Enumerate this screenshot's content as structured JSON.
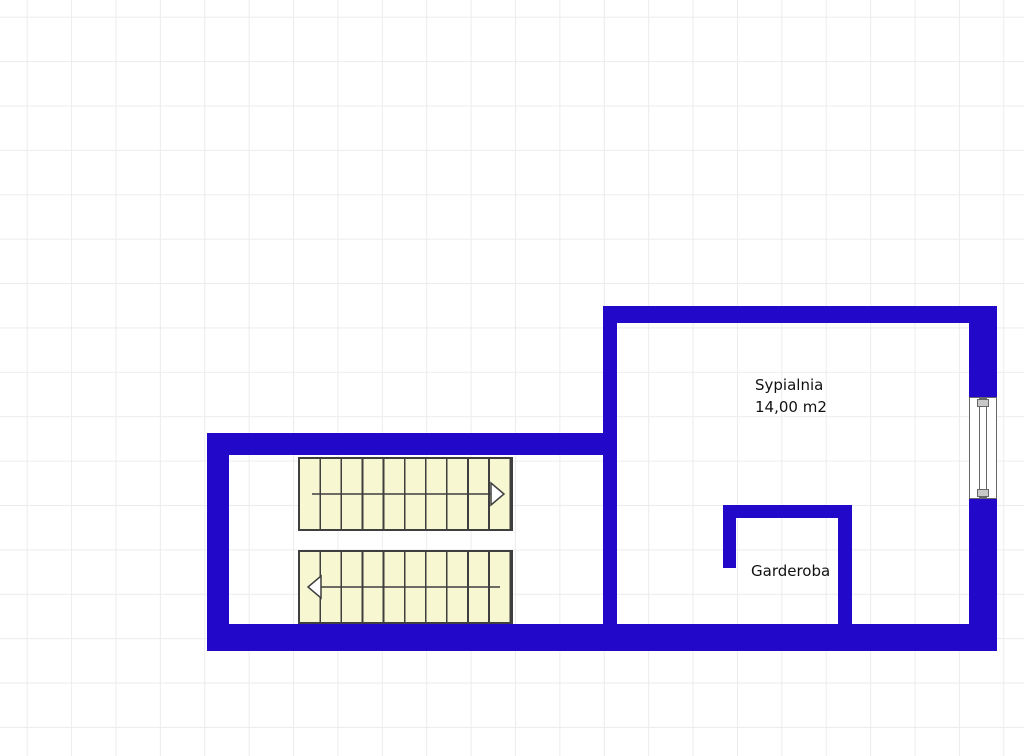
{
  "plan": {
    "type": "floorplan",
    "rooms": [
      {
        "id": "sypialnia",
        "name": "Sypialnia",
        "area": "14,00 m2"
      },
      {
        "id": "garderoba",
        "name": "Garderoba",
        "area": ""
      }
    ],
    "stairs": {
      "flights": [
        {
          "name": "upper-flight",
          "treads": 10,
          "direction": "right"
        },
        {
          "name": "lower-flight",
          "treads": 10,
          "direction": "left"
        }
      ]
    },
    "features": [
      {
        "id": "window",
        "location": "right-wall"
      }
    ]
  },
  "colors": {
    "wall": "#2208C8",
    "stair_fill": "#F7F7D2",
    "stair_line": "#3F3F3F",
    "grid_line": "#ECECEC",
    "background": "#FFFFFF",
    "window_frame": "#666666",
    "window_endcap": "#C8C8C8",
    "text": "#111111"
  }
}
